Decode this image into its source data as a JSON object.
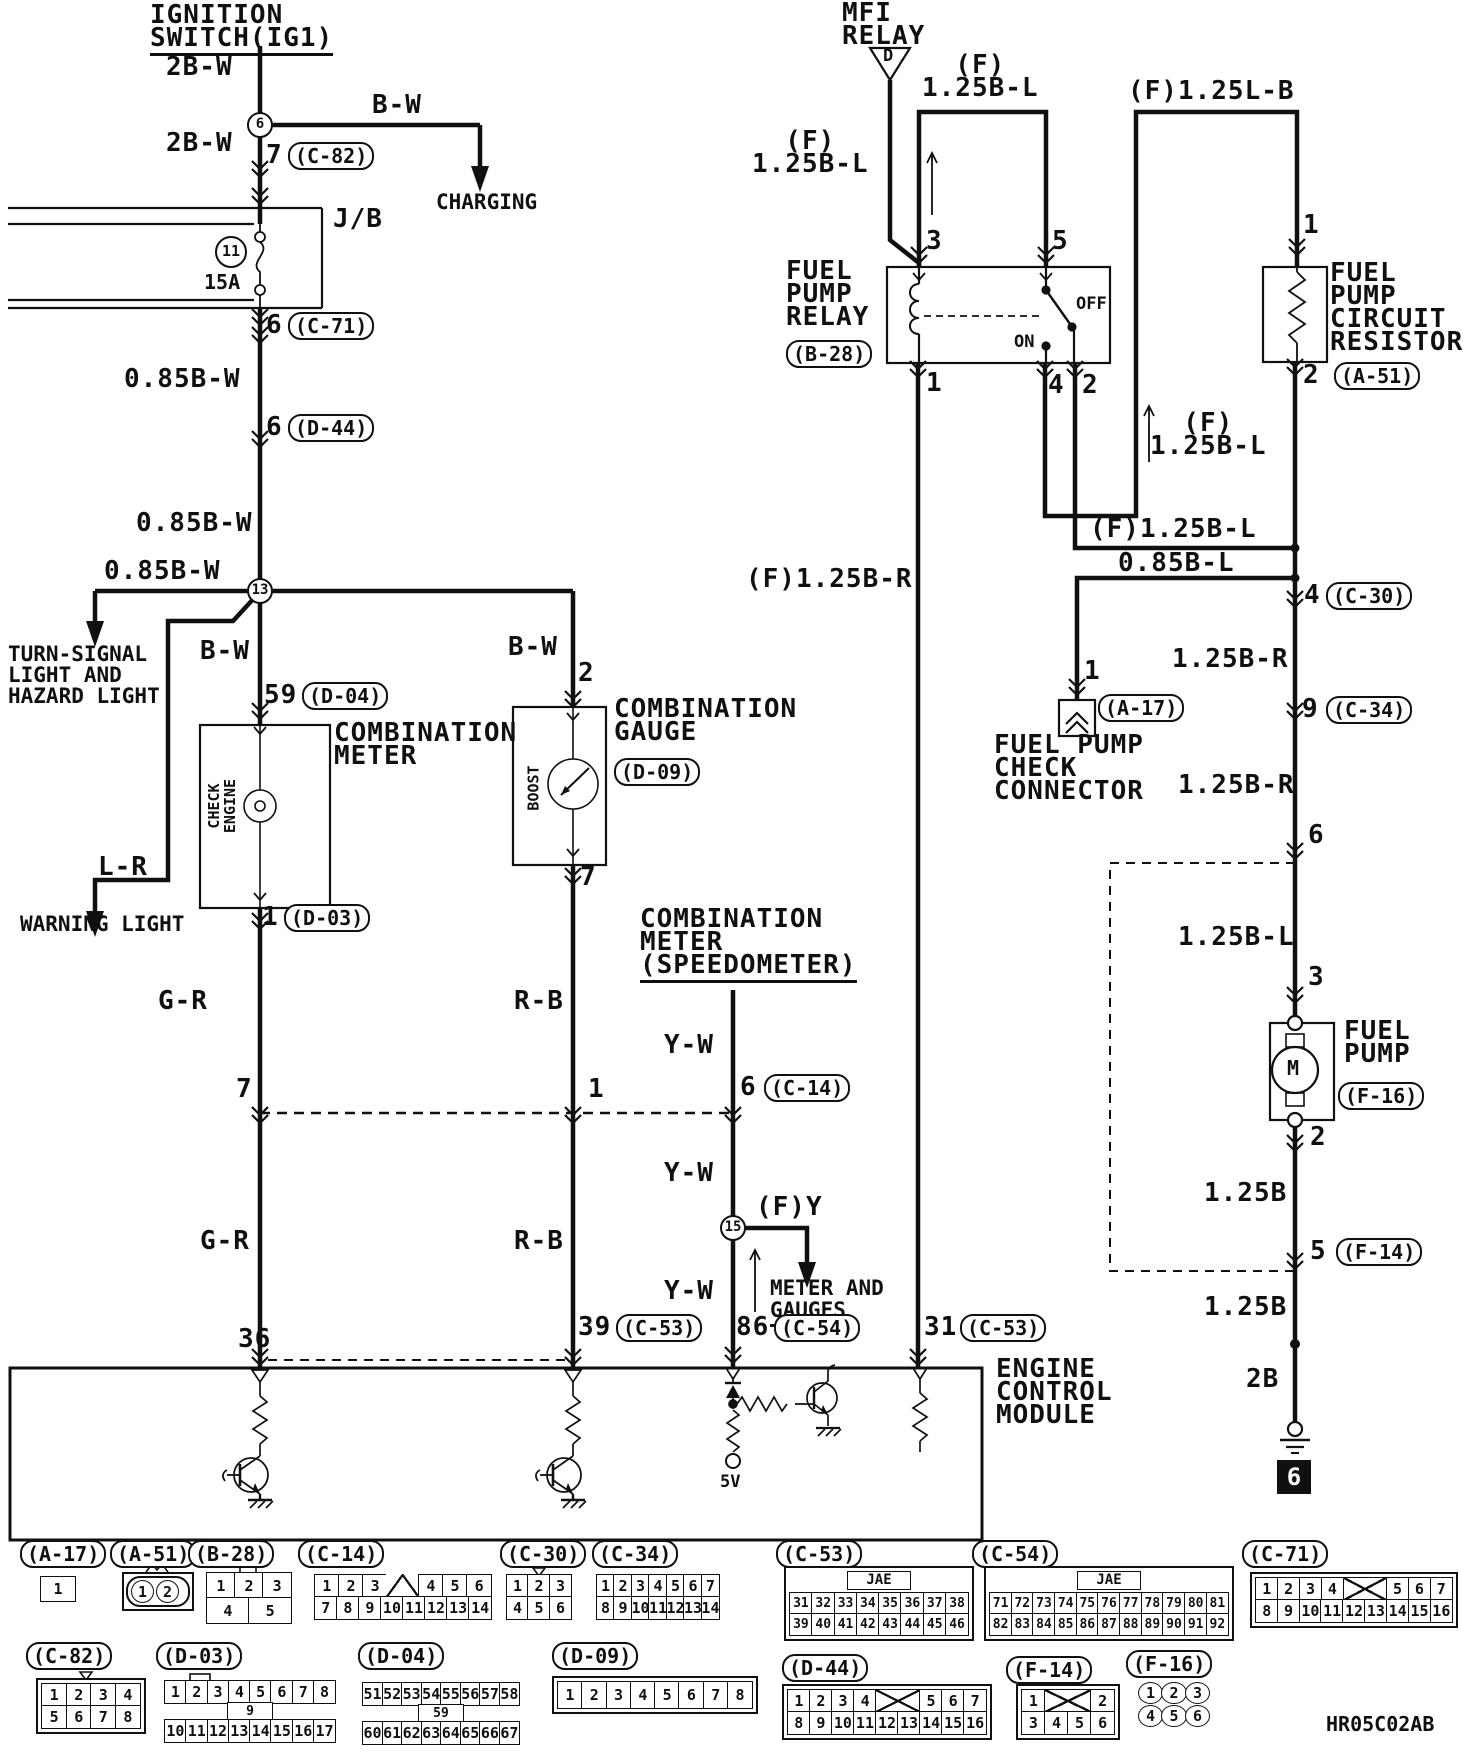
{
  "drawing_code": "HR05C02AB",
  "labels": [
    {
      "n": "ignition-switch-title",
      "t": "IGNITION\nSWITCH(IG1)",
      "x": 150,
      "y": 4,
      "c": "u2"
    },
    {
      "n": "wire-2bw-1",
      "t": "2B-W",
      "x": 166,
      "y": 56
    },
    {
      "n": "node-6",
      "t": "6",
      "x": 247,
      "y": 112,
      "c": "node"
    },
    {
      "n": "wire-bw-charging",
      "t": "B-W",
      "x": 372,
      "y": 94
    },
    {
      "n": "charging-dest",
      "t": "CHARGING",
      "x": 436,
      "y": 192,
      "c": "f21"
    },
    {
      "n": "wire-2bw-2",
      "t": "2B-W",
      "x": 166,
      "y": 132
    },
    {
      "n": "pin-7-c82",
      "t": "7",
      "x": 266,
      "y": 144
    },
    {
      "n": "conn-c82-ref",
      "t": "(C-82)",
      "x": 288,
      "y": 142,
      "c": "oval"
    },
    {
      "n": "jb-label",
      "t": "J/B",
      "x": 333,
      "y": 208
    },
    {
      "n": "fuse-circle-11",
      "t": "11",
      "x": 215,
      "y": 236,
      "c": "circ32"
    },
    {
      "n": "fuse-rating",
      "t": "15A",
      "x": 204,
      "y": 272,
      "c": "f20"
    },
    {
      "n": "pin-6-c71",
      "t": "6",
      "x": 266,
      "y": 314
    },
    {
      "n": "conn-c71-ref",
      "t": "(C-71)",
      "x": 288,
      "y": 312,
      "c": "oval"
    },
    {
      "n": "wire-085bw-1",
      "t": "0.85B-W",
      "x": 124,
      "y": 368
    },
    {
      "n": "pin-6-d44",
      "t": "6",
      "x": 266,
      "y": 416
    },
    {
      "n": "conn-d44-ref",
      "t": "(D-44)",
      "x": 288,
      "y": 414,
      "c": "oval"
    },
    {
      "n": "wire-085bw-2",
      "t": "0.85B-W",
      "x": 136,
      "y": 512
    },
    {
      "n": "wire-085bw-3",
      "t": "0.85B-W",
      "x": 104,
      "y": 560
    },
    {
      "n": "node-13",
      "t": "13",
      "x": 247,
      "y": 578,
      "c": "node"
    },
    {
      "n": "turn-signal-dest",
      "t": "TURN-SIGNAL\nLIGHT AND\nHAZARD LIGHT",
      "x": 8,
      "y": 644,
      "c": "f21"
    },
    {
      "n": "wire-bw-meter",
      "t": "B-W",
      "x": 200,
      "y": 640
    },
    {
      "n": "wire-bw-gauge",
      "t": "B-W",
      "x": 508,
      "y": 636
    },
    {
      "n": "pin-59",
      "t": "59",
      "x": 264,
      "y": 684
    },
    {
      "n": "conn-d04-ref",
      "t": "(D-04)",
      "x": 302,
      "y": 682,
      "c": "oval"
    },
    {
      "n": "pin-2-gauge",
      "t": "2",
      "x": 578,
      "y": 662
    },
    {
      "n": "combination-meter-title",
      "t": "COMBINATION\nMETER",
      "x": 334,
      "y": 722
    },
    {
      "n": "combination-gauge-title",
      "t": "COMBINATION\nGAUGE",
      "x": 614,
      "y": 698
    },
    {
      "n": "conn-d09-ref",
      "t": "(D-09)",
      "x": 614,
      "y": 758,
      "c": "oval"
    },
    {
      "n": "check-engine-label",
      "t": "CHECK\nENGINE",
      "x": 195,
      "y": 790,
      "c": "vert"
    },
    {
      "n": "boost-label",
      "t": "BOOST",
      "x": 511,
      "y": 780,
      "c": "vert"
    },
    {
      "n": "wire-lr",
      "t": "L-R",
      "x": 98,
      "y": 856
    },
    {
      "n": "warning-light-dest",
      "t": "WARNING LIGHT",
      "x": 20,
      "y": 914,
      "c": "f21"
    },
    {
      "n": "pin-1-d03",
      "t": "1",
      "x": 262,
      "y": 906
    },
    {
      "n": "conn-d03-ref",
      "t": "(D-03)",
      "x": 284,
      "y": 904,
      "c": "oval"
    },
    {
      "n": "pin-7-gauge",
      "t": "7",
      "x": 580,
      "y": 866
    },
    {
      "n": "wire-gr-1",
      "t": "G-R",
      "x": 158,
      "y": 990
    },
    {
      "n": "wire-rb-1",
      "t": "R-B",
      "x": 514,
      "y": 990
    },
    {
      "n": "speedometer-title",
      "t": "COMBINATION\nMETER\n(SPEEDOMETER)",
      "x": 640,
      "y": 908,
      "c": "u2"
    },
    {
      "n": "wire-yw-1",
      "t": "Y-W",
      "x": 664,
      "y": 1034
    },
    {
      "n": "pin-7-c14",
      "t": "7",
      "x": 236,
      "y": 1078
    },
    {
      "n": "pin-1-c14",
      "t": "1",
      "x": 588,
      "y": 1078
    },
    {
      "n": "pin-6-c14",
      "t": "6",
      "x": 740,
      "y": 1076
    },
    {
      "n": "conn-c14-ref",
      "t": "(C-14)",
      "x": 764,
      "y": 1074,
      "c": "oval"
    },
    {
      "n": "wire-yw-2",
      "t": "Y-W",
      "x": 664,
      "y": 1162
    },
    {
      "n": "node-15",
      "t": "15",
      "x": 720,
      "y": 1215,
      "c": "node"
    },
    {
      "n": "wire-fy",
      "t": "(F)Y",
      "x": 756,
      "y": 1196
    },
    {
      "n": "meter-gauges-dest",
      "t": "METER AND",
      "x": 770,
      "y": 1278,
      "c": "f21"
    },
    {
      "n": "meter-gauges-dest2",
      "t": "GAUGES",
      "x": 770,
      "y": 1300,
      "c": "f21 u2"
    },
    {
      "n": "wire-yw-3",
      "t": "Y-W",
      "x": 664,
      "y": 1280
    },
    {
      "n": "pin-86",
      "t": "86",
      "x": 736,
      "y": 1316
    },
    {
      "n": "conn-c54-ref",
      "t": "(C-54)",
      "x": 774,
      "y": 1314,
      "c": "oval"
    },
    {
      "n": "pin-39",
      "t": "39",
      "x": 578,
      "y": 1316
    },
    {
      "n": "conn-c53-ref-39",
      "t": "(C-53)",
      "x": 616,
      "y": 1314,
      "c": "oval"
    },
    {
      "n": "pin-31",
      "t": "31",
      "x": 924,
      "y": 1316
    },
    {
      "n": "conn-c53-ref-31",
      "t": "(C-53)",
      "x": 960,
      "y": 1314,
      "c": "oval"
    },
    {
      "n": "pin-36",
      "t": "36",
      "x": 238,
      "y": 1328
    },
    {
      "n": "wire-gr-2",
      "t": "G-R",
      "x": 200,
      "y": 1230
    },
    {
      "n": "wire-rb-2",
      "t": "R-B",
      "x": 514,
      "y": 1230
    },
    {
      "n": "ecm-title",
      "t": "ENGINE\nCONTROL\nMODULE",
      "x": 996,
      "y": 1358
    },
    {
      "n": "ecm-5v",
      "t": "5V",
      "x": 720,
      "y": 1474,
      "c": "f17"
    },
    {
      "n": "mfi-relay-title",
      "t": "MFI\nRELAY",
      "x": 842,
      "y": 2
    },
    {
      "n": "mfi-triangle-d",
      "t": "D",
      "x": 883,
      "y": 48,
      "c": "f17"
    },
    {
      "n": "wire-f125bl-mfi",
      "t": "  (F)\n1.25B-L",
      "x": 752,
      "y": 130
    },
    {
      "n": "wire-f125bl-top",
      "t": "  (F)\n1.25B-L",
      "x": 922,
      "y": 54
    },
    {
      "n": "wire-f125lb",
      "t": "(F)1.25L-B",
      "x": 1128,
      "y": 80
    },
    {
      "n": "fuel-pump-relay-title",
      "t": "FUEL\nPUMP\nRELAY",
      "x": 786,
      "y": 260
    },
    {
      "n": "conn-b28-ref",
      "t": "(B-28)",
      "x": 786,
      "y": 340,
      "c": "oval"
    },
    {
      "n": "pin-3-relay",
      "t": "3",
      "x": 926,
      "y": 230
    },
    {
      "n": "pin-5-relay",
      "t": "5",
      "x": 1052,
      "y": 230
    },
    {
      "n": "relay-off",
      "t": "OFF",
      "x": 1076,
      "y": 296,
      "c": "f17"
    },
    {
      "n": "relay-on",
      "t": "ON",
      "x": 1014,
      "y": 334,
      "c": "f17"
    },
    {
      "n": "pin-1-relay",
      "t": "1",
      "x": 926,
      "y": 372
    },
    {
      "n": "pin-4-relay",
      "t": "4",
      "x": 1048,
      "y": 374
    },
    {
      "n": "pin-2-relay",
      "t": "2",
      "x": 1082,
      "y": 374
    },
    {
      "n": "resistor-title",
      "t": "FUEL\nPUMP\nCIRCUIT\nRESISTOR",
      "x": 1330,
      "y": 262
    },
    {
      "n": "pin-1-resistor",
      "t": "1",
      "x": 1303,
      "y": 214
    },
    {
      "n": "conn-a51-ref",
      "t": "(A-51)",
      "x": 1334,
      "y": 362,
      "c": "oval"
    },
    {
      "n": "pin-2-resistor",
      "t": "2",
      "x": 1303,
      "y": 364
    },
    {
      "n": "wire-f125bl-riser",
      "t": "  (F)\n1.25B-L",
      "x": 1150,
      "y": 412
    },
    {
      "n": "wire-f125bl-horiz",
      "t": "(F)1.25B-L",
      "x": 1090,
      "y": 518
    },
    {
      "n": "wire-085bl",
      "t": "0.85B-L",
      "x": 1118,
      "y": 552
    },
    {
      "n": "wire-f125br",
      "t": "(F)1.25B-R",
      "x": 746,
      "y": 568
    },
    {
      "n": "pin-4-c30",
      "t": "4",
      "x": 1304,
      "y": 584
    },
    {
      "n": "conn-c30-ref",
      "t": "(C-30)",
      "x": 1326,
      "y": 582,
      "c": "oval"
    },
    {
      "n": "wire-125br-1",
      "t": "1.25B-R",
      "x": 1172,
      "y": 648
    },
    {
      "n": "pin-1-a17",
      "t": "1",
      "x": 1084,
      "y": 660
    },
    {
      "n": "conn-a17-ref",
      "t": "(A-17)",
      "x": 1098,
      "y": 694,
      "c": "oval"
    },
    {
      "n": "fp-check-title",
      "t": "FUEL PUMP\nCHECK\nCONNECTOR",
      "x": 994,
      "y": 734
    },
    {
      "n": "pin-9-c34",
      "t": "9",
      "x": 1302,
      "y": 698
    },
    {
      "n": "conn-c34-ref",
      "t": "(C-34)",
      "x": 1326,
      "y": 696,
      "c": "oval"
    },
    {
      "n": "wire-125br-2",
      "t": "1.25B-R",
      "x": 1178,
      "y": 774
    },
    {
      "n": "pin-6-tank",
      "t": "6",
      "x": 1308,
      "y": 824
    },
    {
      "n": "wire-125bl-tank",
      "t": "1.25B-L",
      "x": 1178,
      "y": 926
    },
    {
      "n": "pin-3-pump",
      "t": "3",
      "x": 1308,
      "y": 966
    },
    {
      "n": "fuel-pump-title",
      "t": "FUEL\nPUMP",
      "x": 1344,
      "y": 1020
    },
    {
      "n": "conn-f16-ref",
      "t": "(F-16)",
      "x": 1338,
      "y": 1082,
      "c": "oval"
    },
    {
      "n": "pump-motor-m",
      "t": "M",
      "x": 1287,
      "y": 1058,
      "c": "f20"
    },
    {
      "n": "pin-2-pump",
      "t": "2",
      "x": 1310,
      "y": 1126
    },
    {
      "n": "wire-125b-1",
      "t": "1.25B",
      "x": 1204,
      "y": 1182
    },
    {
      "n": "pin-5-f14",
      "t": "5",
      "x": 1310,
      "y": 1240
    },
    {
      "n": "conn-f14-ref",
      "t": "(F-14)",
      "x": 1336,
      "y": 1238,
      "c": "oval"
    },
    {
      "n": "wire-125b-2",
      "t": "1.25B",
      "x": 1204,
      "y": 1296
    },
    {
      "n": "wire-2b",
      "t": "2B",
      "x": 1246,
      "y": 1368
    },
    {
      "n": "ground-ref-6",
      "t": "6",
      "x": 1277,
      "y": 1460,
      "c": "gbox"
    },
    {
      "n": "drawing-code",
      "t": "HR05C02AB",
      "x": 1326,
      "y": 1714,
      "c": "f20"
    }
  ],
  "connectors": [
    {
      "id": "A-17",
      "label": "(A-17)",
      "ox": 20,
      "oy": 1540,
      "bx": 40,
      "by": 1576,
      "w": 36,
      "style": "c-a-17",
      "rows": [
        [
          "1"
        ]
      ]
    },
    {
      "id": "A-51",
      "label": "(A-51)",
      "ox": 110,
      "oy": 1540,
      "bx": 122,
      "by": 1572,
      "w": 64,
      "style": "a51",
      "rows": [
        [
          "1",
          "2"
        ]
      ]
    },
    {
      "id": "B-28",
      "label": "(B-28)",
      "ox": 188,
      "oy": 1540,
      "bx": 206,
      "by": 1572,
      "w": 86,
      "style": "c-b-28",
      "rows": [
        [
          "1",
          "2",
          "3"
        ],
        [
          "4",
          "5"
        ]
      ]
    },
    {
      "id": "C-14",
      "label": "(C-14)",
      "ox": 298,
      "oy": 1540,
      "bx": 314,
      "by": 1574,
      "w": 178,
      "style": "",
      "rows": [
        [
          "1",
          "2",
          "3",
          "V:1.4",
          "4",
          "5",
          "6"
        ],
        [
          "7",
          "8",
          "9",
          "10",
          "11",
          "12",
          "13",
          "14"
        ]
      ]
    },
    {
      "id": "C-30",
      "label": "(C-30)",
      "ox": 500,
      "oy": 1540,
      "bx": 506,
      "by": 1574,
      "w": 66,
      "style": "",
      "rows": [
        [
          "1",
          "2",
          "3"
        ],
        [
          "4",
          "5",
          "6"
        ]
      ]
    },
    {
      "id": "C-34",
      "label": "(C-34)",
      "ox": 592,
      "oy": 1540,
      "bx": 596,
      "by": 1574,
      "w": 124,
      "style": "",
      "rows": [
        [
          "1",
          "2",
          "3",
          "4",
          "5",
          "6",
          "7"
        ],
        [
          "8",
          "9",
          "10",
          "11",
          "12",
          "13",
          "14"
        ]
      ]
    },
    {
      "id": "C-53",
      "label": "(C-53)",
      "ox": 776,
      "oy": 1540,
      "bx": 784,
      "by": 1566,
      "w": 180,
      "style": "jae",
      "tab": "JAE",
      "rows": [
        [
          "31",
          "32",
          "33",
          "34",
          "35",
          "36",
          "37",
          "38"
        ],
        [
          "39",
          "40",
          "41",
          "42",
          "43",
          "44",
          "45",
          "46"
        ]
      ]
    },
    {
      "id": "C-54",
      "label": "(C-54)",
      "ox": 972,
      "oy": 1540,
      "bx": 984,
      "by": 1566,
      "w": 240,
      "style": "jae",
      "tab": "JAE",
      "rows": [
        [
          "71",
          "72",
          "73",
          "74",
          "75",
          "76",
          "77",
          "78",
          "79",
          "80",
          "81"
        ],
        [
          "82",
          "83",
          "84",
          "85",
          "86",
          "87",
          "88",
          "89",
          "90",
          "91",
          "92"
        ]
      ]
    },
    {
      "id": "C-71",
      "label": "(C-71)",
      "ox": 1242,
      "oy": 1540,
      "bx": 1250,
      "by": 1572,
      "w": 198,
      "style": "dbl",
      "rows": [
        [
          "1",
          "2",
          "3",
          "4",
          "X:2",
          "5",
          "6",
          "7"
        ],
        [
          "8",
          "9",
          "10",
          "11",
          "12",
          "13",
          "14",
          "15",
          "16"
        ]
      ]
    },
    {
      "id": "C-82",
      "label": "(C-82)",
      "ox": 26,
      "oy": 1642,
      "bx": 36,
      "by": 1678,
      "w": 100,
      "style": "dbl",
      "rows": [
        [
          "1",
          "2",
          "3",
          "4"
        ],
        [
          "5",
          "6",
          "7",
          "8"
        ]
      ]
    },
    {
      "id": "D-03",
      "label": "(D-03)",
      "ox": 156,
      "oy": 1642,
      "bx": 164,
      "by": 1680,
      "w": 172,
      "style": "",
      "mid": "9",
      "rows": [
        [
          "1",
          "2",
          "3",
          "4",
          "5",
          "6",
          "7",
          "8"
        ],
        [
          "10",
          "11",
          "12",
          "13",
          "14",
          "15",
          "16",
          "17"
        ]
      ]
    },
    {
      "id": "D-04",
      "label": "(D-04)",
      "ox": 358,
      "oy": 1642,
      "bx": 362,
      "by": 1682,
      "w": 158,
      "style": "",
      "mid": "59",
      "rows": [
        [
          "51",
          "52",
          "53",
          "54",
          "55",
          "56",
          "57",
          "58"
        ],
        [
          "60",
          "61",
          "62",
          "63",
          "64",
          "65",
          "66",
          "67"
        ]
      ]
    },
    {
      "id": "D-09",
      "label": "(D-09)",
      "ox": 552,
      "oy": 1642,
      "bx": 552,
      "by": 1676,
      "w": 196,
      "style": "dbl c-d-09",
      "rows": [
        [
          "1",
          "2",
          "3",
          "4",
          "5",
          "6",
          "7",
          "8"
        ]
      ]
    },
    {
      "id": "D-44",
      "label": "(D-44)",
      "ox": 782,
      "oy": 1654,
      "bx": 782,
      "by": 1684,
      "w": 200,
      "style": "dbl",
      "rows": [
        [
          "1",
          "2",
          "3",
          "4",
          "X:2",
          "5",
          "6",
          "7"
        ],
        [
          "8",
          "9",
          "10",
          "11",
          "12",
          "13",
          "14",
          "15",
          "16"
        ]
      ]
    },
    {
      "id": "F-14",
      "label": "(F-14)",
      "ox": 1006,
      "oy": 1656,
      "bx": 1016,
      "by": 1684,
      "w": 94,
      "style": "dbl",
      "rows": [
        [
          "1",
          "X:2",
          "2"
        ],
        [
          "3",
          "4",
          "5",
          "6"
        ]
      ]
    },
    {
      "id": "F-16",
      "label": "(F-16)",
      "ox": 1126,
      "oy": 1650,
      "bx": 1138,
      "by": 1682,
      "w": 72,
      "style": "circles",
      "rows": [
        [
          "1",
          "2",
          "3"
        ],
        [
          "4",
          "5",
          "6"
        ]
      ]
    }
  ]
}
